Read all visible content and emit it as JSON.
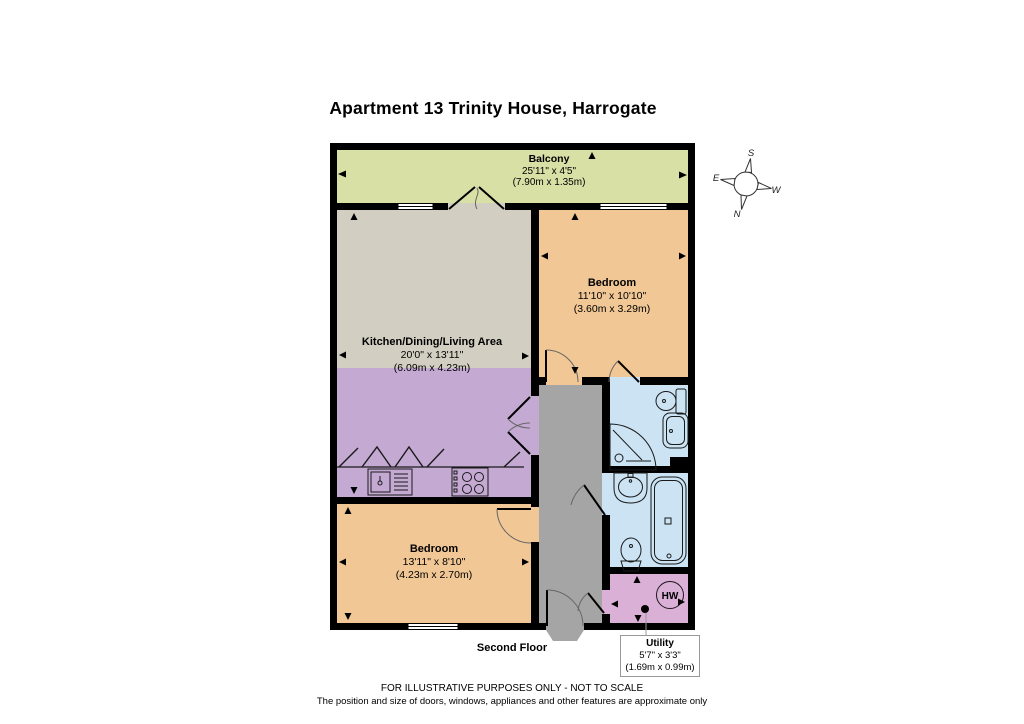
{
  "title": "Apartment 13 Trinity House, Harrogate",
  "floor_label": "Second Floor",
  "rooms": {
    "balcony": {
      "name": "Balcony",
      "imperial": "25'11\" x 4'5\"",
      "metric": "(7.90m x 1.35m)"
    },
    "bedroom1": {
      "name": "Bedroom",
      "imperial": "11'10\" x 10'10\"",
      "metric": "(3.60m x 3.29m)"
    },
    "kitchen": {
      "name": "Kitchen/Dining/Living Area",
      "imperial": "20'0\" x 13'11\"",
      "metric": "(6.09m x 4.23m)"
    },
    "bedroom2": {
      "name": "Bedroom",
      "imperial": "13'11\" x 8'10\"",
      "metric": "(4.23m x 2.70m)"
    },
    "utility": {
      "name": "Utility",
      "imperial": "5'7\" x 3'3\"",
      "metric": "(1.69m x 0.99m)"
    }
  },
  "labels": {
    "hot_water": "HW"
  },
  "compass": {
    "n": "N",
    "s": "S",
    "e": "E",
    "w": "W"
  },
  "footer": {
    "line1": "FOR ILLUSTRATIVE PURPOSES ONLY - NOT TO SCALE",
    "line2": "The position and size of doors, windows, appliances and other features are approximate only"
  },
  "colors": {
    "balcony": "#d9e0a5",
    "living": "#d2cec1",
    "kitchen": "#c4a9d3",
    "bedroom": "#f1c795",
    "bathroom": "#cbe3f3",
    "utility": "#dab0d6",
    "hallway": "#a5a5a5",
    "wall": "#000000"
  }
}
